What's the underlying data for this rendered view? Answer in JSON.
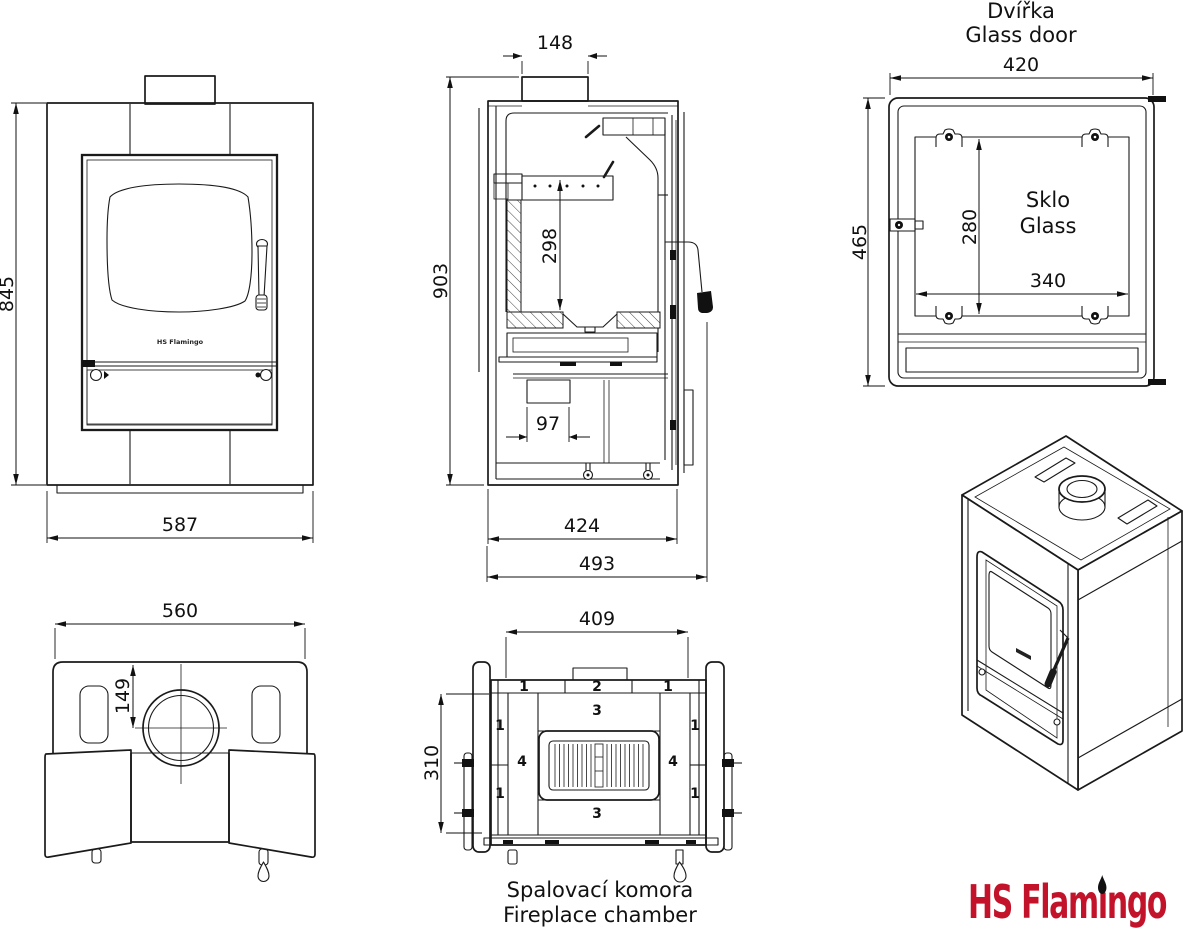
{
  "front_view": {
    "dim_height": "845",
    "dim_width": "587",
    "door_logo": "HS Flamingo"
  },
  "section_view": {
    "dim_flue_width": "148",
    "dim_total_height": "903",
    "dim_firebox_height": "298",
    "dim_grate_width": "97",
    "dim_body_depth": "424",
    "dim_total_depth": "493"
  },
  "door_view": {
    "title_cs": "Dvířka",
    "title_en": "Glass door",
    "dim_width": "420",
    "dim_height": "465",
    "dim_glass_height": "280",
    "dim_glass_width": "340",
    "glass_label_cs": "Sklo",
    "glass_label_en": "Glass"
  },
  "top_view": {
    "dim_width": "560",
    "dim_flue_offset": "149"
  },
  "chamber_view": {
    "dim_width": "409",
    "dim_height": "310",
    "caption_cs": "Spalovací komora",
    "caption_en": "Fireplace chamber",
    "bricks": {
      "top_left": "1",
      "top_center": "2",
      "top_right": "1",
      "left_upper": "1",
      "left_lower": "1",
      "right_upper": "1",
      "right_lower": "1",
      "side_left": "4",
      "side_right": "4",
      "center_top": "3",
      "center_bottom": "3"
    }
  },
  "logo": {
    "text": "HS Flamingo",
    "part1": "HS Flam",
    "dotless_i": "ı",
    "part2": "ngo",
    "color": "#c3132b"
  }
}
